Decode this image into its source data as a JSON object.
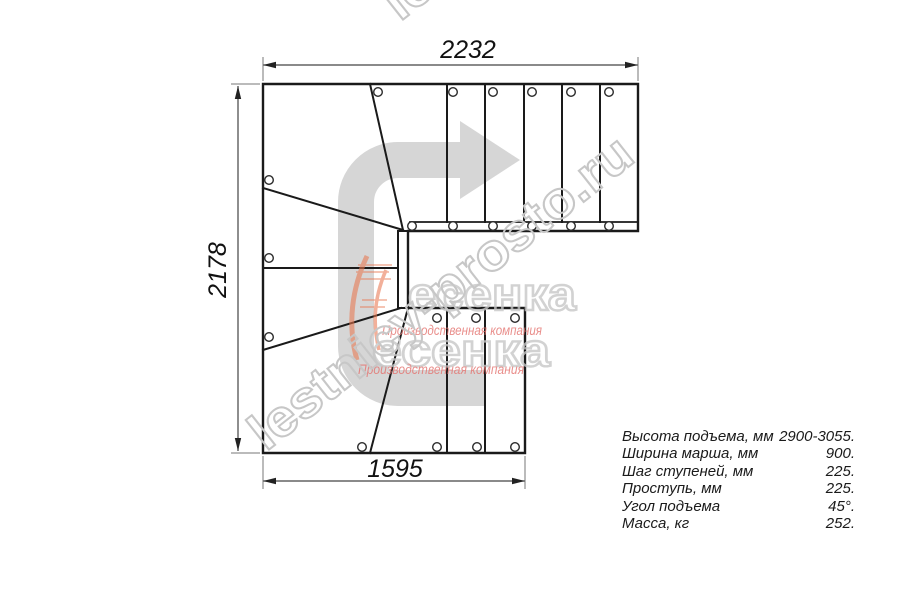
{
  "drawing": {
    "title": "L-shaped staircase plan view",
    "dim_top": "2232",
    "dim_left": "2178",
    "dim_bottom": "1595"
  },
  "watermark": {
    "site": "lestnicy-prosto.ru",
    "logo_text": "есенка",
    "logo_caption": "Производственная компания"
  },
  "specs": {
    "rows": [
      {
        "label": "Высота подъема, мм",
        "value": "2900-3055."
      },
      {
        "label": "Ширина марша, мм",
        "value": "900."
      },
      {
        "label": "Шаг ступеней, мм",
        "value": "225."
      },
      {
        "label": "Проступь, мм",
        "value": "225."
      },
      {
        "label": "Угол подъема",
        "value": "45°."
      },
      {
        "label": "Масса, кг",
        "value": "252."
      }
    ]
  },
  "colors": {
    "line": "#1a1a1a",
    "dim_line": "#444444",
    "ext_line": "#777777",
    "arrow": "#d6d6d6",
    "watermark_gray": "#c7c7c7",
    "logo_red": "#e4736f",
    "logo_orange": "#e8764f"
  }
}
